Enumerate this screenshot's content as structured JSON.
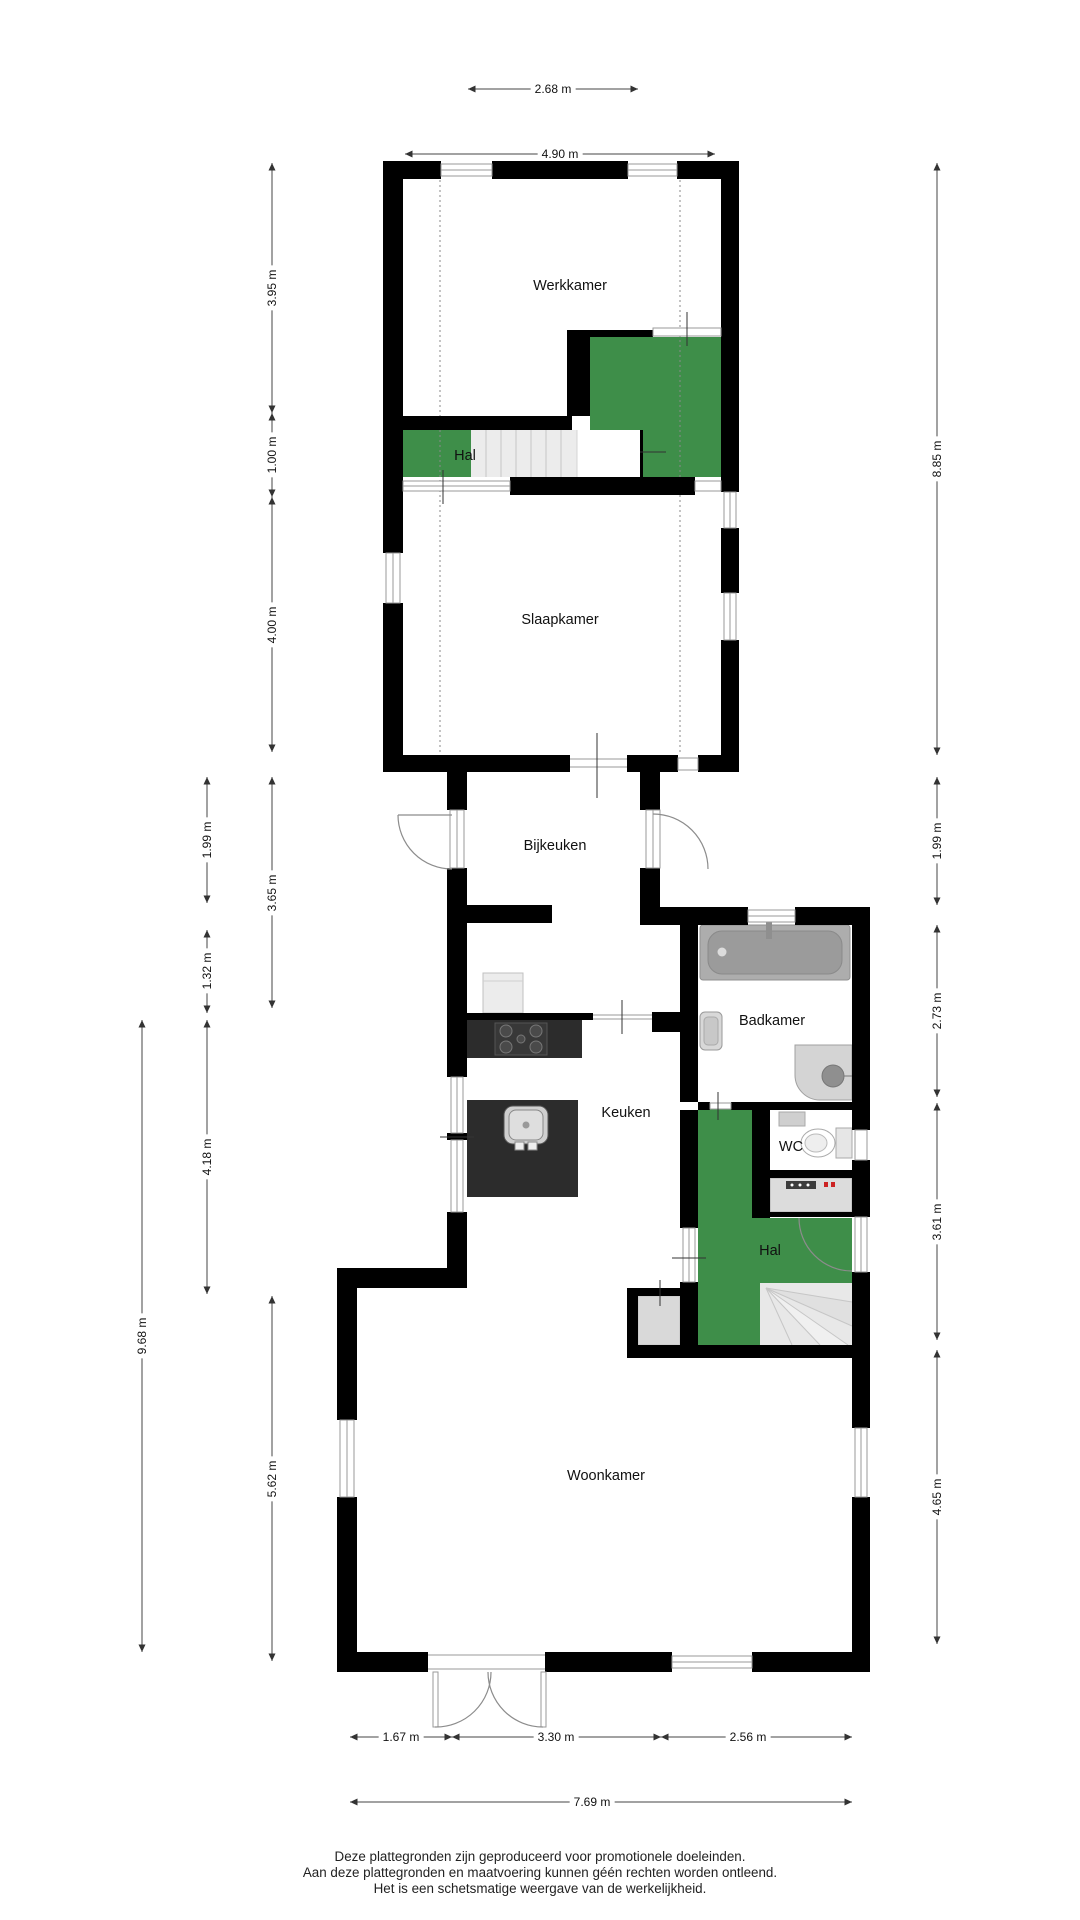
{
  "plan": {
    "rooms": {
      "werkkamer": "Werkkamer",
      "hal_upper": "Hal",
      "slaapkamer": "Slaapkamer",
      "bijkeuken": "Bijkeuken",
      "keuken": "Keuken",
      "badkamer": "Badkamer",
      "wc": "WC",
      "hal": "Hal",
      "woonkamer": "Woonkamer"
    },
    "dimensions": {
      "top_inner": "2.68 m",
      "top_outer": "4.90 m",
      "left_395": "3.95 m",
      "left_100": "1.00 m",
      "left_400": "4.00 m",
      "left_365": "3.65 m",
      "left_562": "5.62 m",
      "left_199": "1.99 m",
      "left_132": "1.32 m",
      "left_418": "4.18 m",
      "left_968": "9.68 m",
      "right_885": "8.85 m",
      "right_199": "1.99 m",
      "right_273": "2.73 m",
      "right_361": "3.61 m",
      "right_465": "4.65 m",
      "bottom_167": "1.67 m",
      "bottom_330": "3.30 m",
      "bottom_256": "2.56 m",
      "bottom_769": "7.69 m"
    },
    "colors": {
      "accent_green": "#3e8e49",
      "wall": "#000000"
    },
    "footer": {
      "line1": "Deze plattegronden zijn geproduceerd voor promotionele doeleinden.",
      "line2": "Aan deze plattegronden en maatvoering kunnen géén rechten worden ontleend.",
      "line3": "Het is een schetsmatige weergave van de werkelijkheid."
    }
  }
}
